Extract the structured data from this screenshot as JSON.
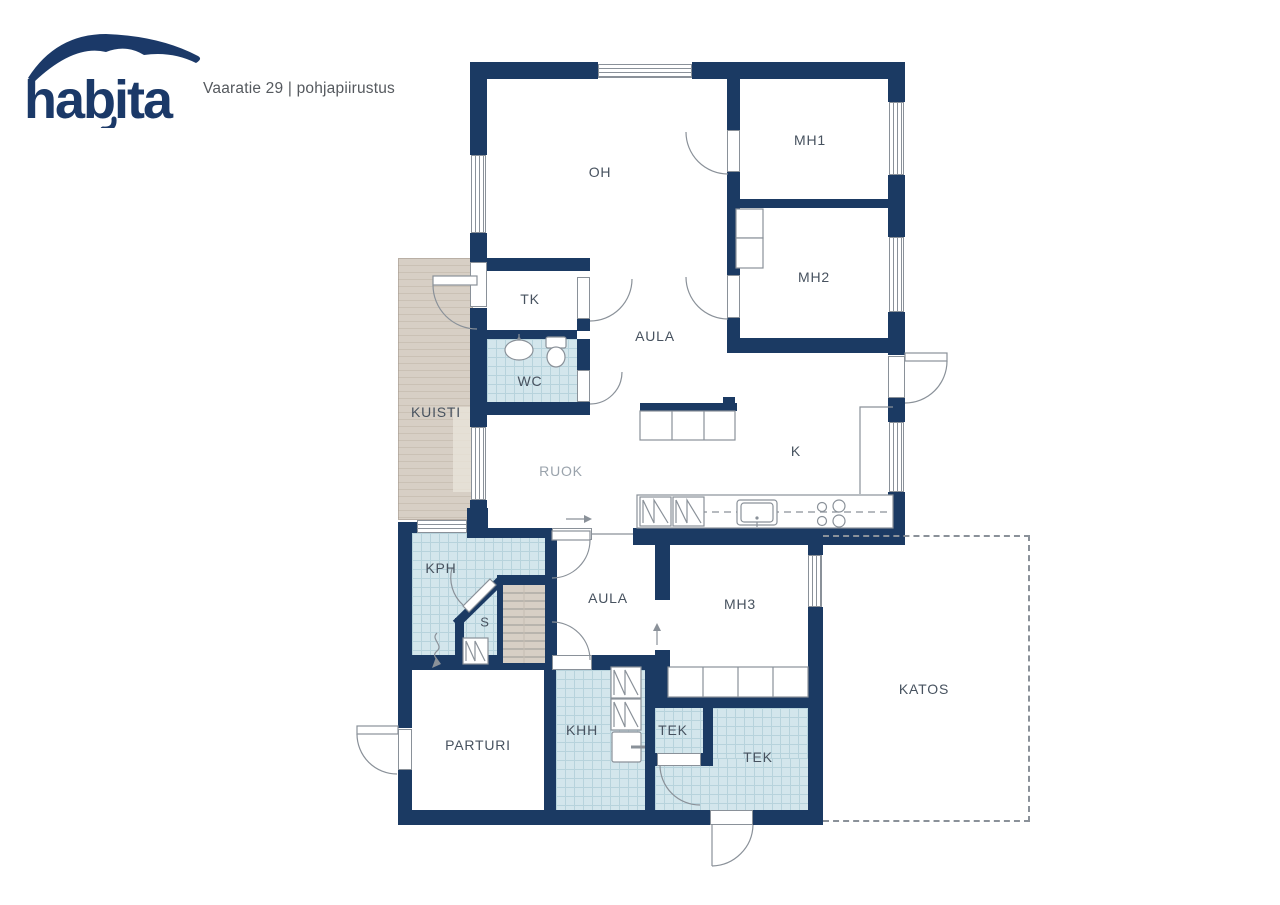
{
  "header": {
    "brand": "habita",
    "subtitle": "Vaaratie 29 | pohjapiirustus"
  },
  "rooms": {
    "oh": "OH",
    "mh1": "MH1",
    "mh2": "MH2",
    "tk": "TK",
    "aula_upper": "AULA",
    "wc": "WC",
    "kuisti": "KUISTI",
    "ruok": "RUOK",
    "k": "K",
    "kph": "KPH",
    "s": "S",
    "aula_lower": "AULA",
    "mh3": "MH3",
    "katos": "KATOS",
    "parturi": "PARTURI",
    "khh": "KHH",
    "tek_small": "TEK",
    "tek_big": "TEK"
  },
  "colors": {
    "wall": "#1b3a63",
    "tile": "#d3e6ec",
    "tile_line": "#b7d3dc",
    "deck": "#d7cfc5",
    "deck_line": "#cac1b5",
    "deck_light": "#e9e3da",
    "line": "#8a9199",
    "label": "#47525f",
    "label_muted": "#9aa3ac",
    "brand": "#1b3968",
    "subtitle": "#55595e"
  }
}
